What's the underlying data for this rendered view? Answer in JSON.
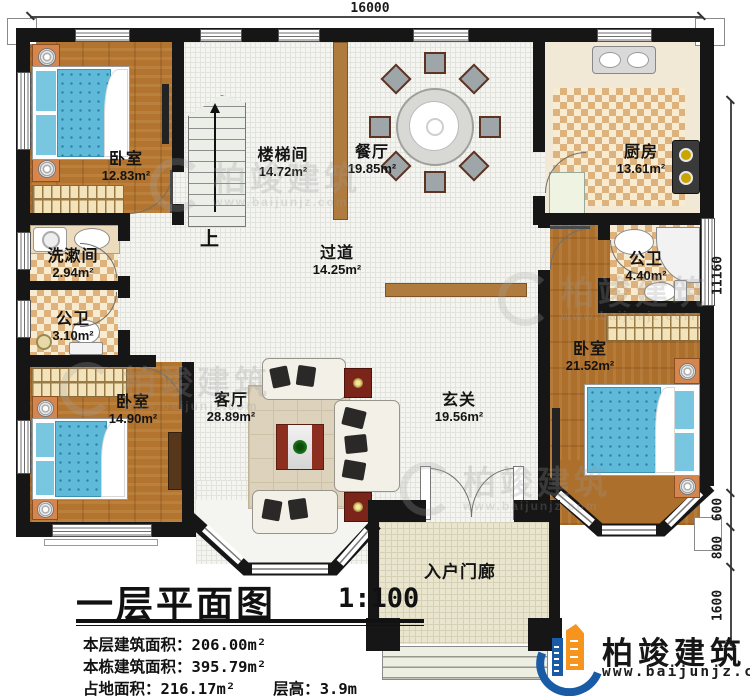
{
  "dims": {
    "top": "16000",
    "right_total": "11160",
    "seg_600": "600",
    "seg_800": "800",
    "seg_1600": "1600"
  },
  "rooms": [
    {
      "name": "卧室",
      "area": "12.83m²"
    },
    {
      "name": "楼梯间",
      "area": "14.72m²"
    },
    {
      "name": "餐厅",
      "area": "19.85m²"
    },
    {
      "name": "厨房",
      "area": "13.61m²"
    },
    {
      "name": "洗漱间",
      "area": "2.94m²"
    },
    {
      "name": "公卫",
      "area": "3.10m²"
    },
    {
      "name": "过道",
      "area": "14.25m²"
    },
    {
      "name": "公卫",
      "area": "4.40m²"
    },
    {
      "name": "卧室",
      "area": "21.52m²"
    },
    {
      "name": "卧室",
      "area": "14.90m²"
    },
    {
      "name": "客厅",
      "area": "28.89m²"
    },
    {
      "name": "玄关",
      "area": "19.56m²"
    },
    {
      "name": "入户门廊",
      "area": ""
    }
  ],
  "stair_up": "上",
  "titleblock": {
    "title": "一层平面图",
    "scale": "1:100",
    "stats": [
      {
        "label": "本层建筑面积：",
        "value": "206.00m²"
      },
      {
        "label": "本栋建筑面积：",
        "value": "395.79m²"
      },
      {
        "label": "占地面积：",
        "value": "216.17m²"
      },
      {
        "label": "层高：",
        "value": "3.9m"
      }
    ]
  },
  "brand": {
    "name": "柏竣建筑",
    "site": "www.baijunjz.com"
  },
  "watermark": {
    "name": "柏竣建筑",
    "site": "www.baijunjz.com"
  },
  "colors": {
    "wall": "#161616",
    "wood": "#b2742f",
    "checker": "#ddb27c",
    "bed_blue": "#5fb9d9",
    "logo_blue": "#1a5ba6",
    "logo_orange": "#f7941d"
  }
}
